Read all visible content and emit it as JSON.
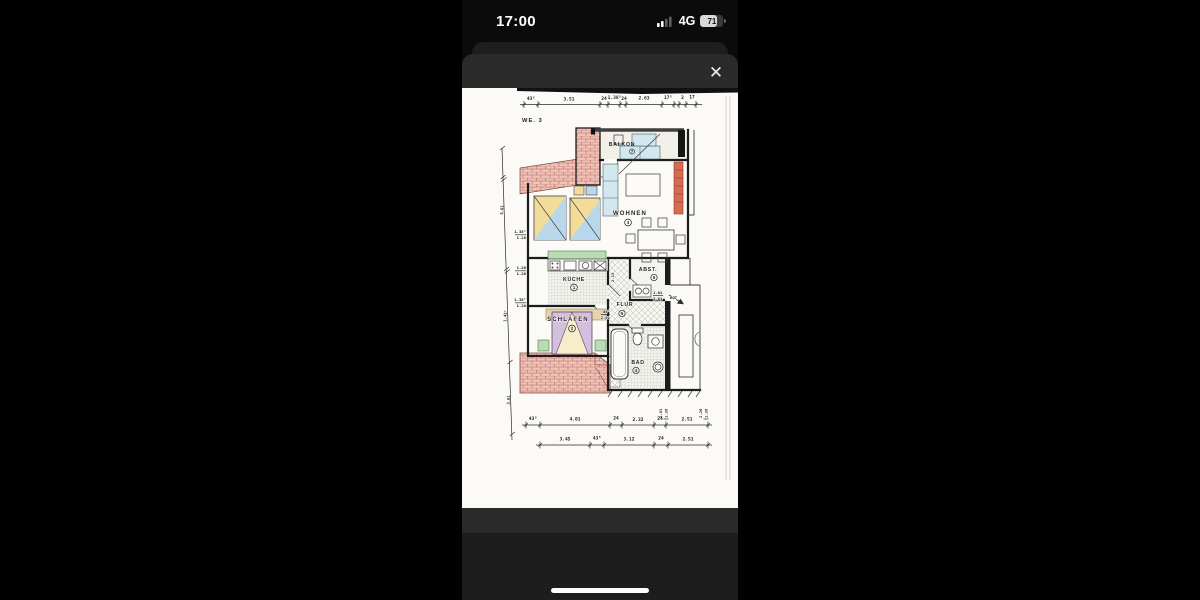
{
  "status_bar": {
    "time": "17:00",
    "network": "4G",
    "battery_percent": "71"
  },
  "modal": {
    "close_icon": "✕"
  },
  "floorplan": {
    "unit": "WE. 3",
    "top_dims": [
      "43⁵",
      "3.51",
      "24",
      "1.38⁵",
      "24",
      "2.63",
      "17⁵",
      "2",
      "17"
    ],
    "bottom_dims_row1": [
      "43⁵",
      "4.01",
      "24",
      "2.32",
      "24",
      "2.51"
    ],
    "bottom_dims_row2": [
      "3.45",
      "43⁵",
      "3.12",
      "24",
      "2.51"
    ],
    "left_dims": [
      "5.61",
      "1.43⁵",
      "3.61"
    ],
    "window_labels": [
      {
        "w": "1.38⁵",
        "h": "1.26"
      },
      {
        "w": "1.26",
        "h": "1.26"
      },
      {
        "w": "1.38⁵",
        "h": "1.26"
      }
    ],
    "side_labels": [
      {
        "w": "1.01",
        "h": "1.26"
      },
      {
        "w": "2.26",
        "h": "1.26"
      }
    ],
    "door_labels": {
      "flur_w": "1.01",
      "flur_h": "2.01",
      "flur_note": "ROT",
      "schlafen_w": "88⁵",
      "schlafen_h": "2.01",
      "kueche_w": "2.15"
    },
    "rooms": {
      "kueche": {
        "name": "KÜCHE",
        "number": "1"
      },
      "schlafen": {
        "name": "SCHLAFEN",
        "number": "2"
      },
      "wohnen": {
        "name": "WOHNEN",
        "number": "3"
      },
      "bad": {
        "name": "BAD",
        "number": "4"
      },
      "flur": {
        "name": "FLUR",
        "number": "5"
      },
      "abst": {
        "name": "ABST.",
        "number": "6"
      },
      "balkon": {
        "name": "BALKON",
        "number": "7"
      }
    },
    "colors": {
      "paper": "#fbfaf7",
      "wall": "#1c1c1c",
      "brick": "#f0c2b6",
      "radiator": "#d96a54",
      "skylight_yellow": "#f3dc9a",
      "skylight_blue": "#b9d7ea",
      "sill_green": "#b9dcb4",
      "wardrobe_tan": "#e6d3ac",
      "bed_purple": "#d5bfdf",
      "bed_blanket": "#f6eecb",
      "furniture_cyan": "#d3e8ee",
      "sheet": "#2a2a2a"
    }
  }
}
